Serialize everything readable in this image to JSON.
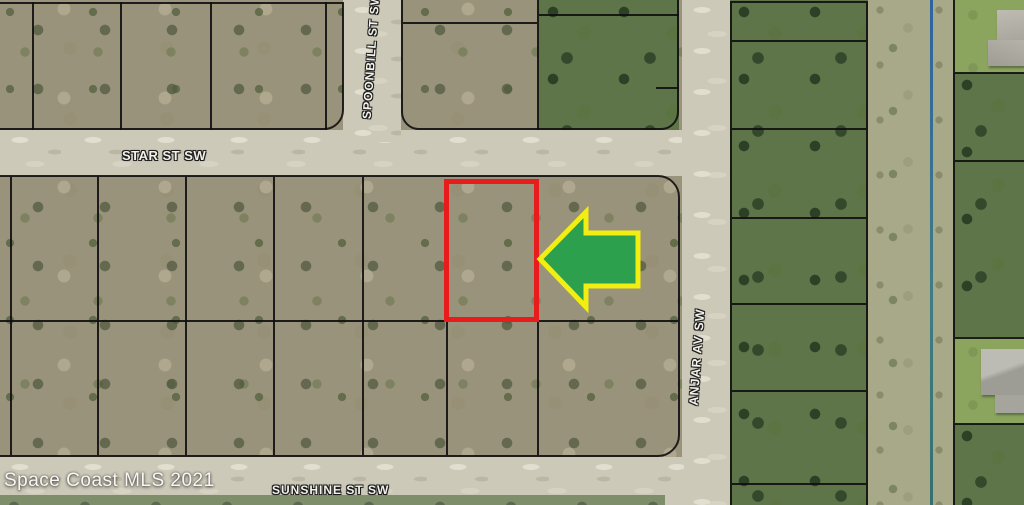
{
  "map": {
    "streets": {
      "star": "STAR ST SW",
      "spoonbill": "SPOONBILL ST SW",
      "anjar": "ANJAR AV SW",
      "sunshine": "SUNSHINE ST SW"
    },
    "watermark": "Space Coast MLS 2021",
    "annotations": {
      "subject_parcel_outline_color": "#e81c1c",
      "arrow_fill": "#2da04e",
      "arrow_stroke": "#f2ee12",
      "arrow_direction": "left"
    },
    "features": {
      "canal_color": "#2e6292",
      "parcel_line_color": "#1a1a1a"
    }
  }
}
